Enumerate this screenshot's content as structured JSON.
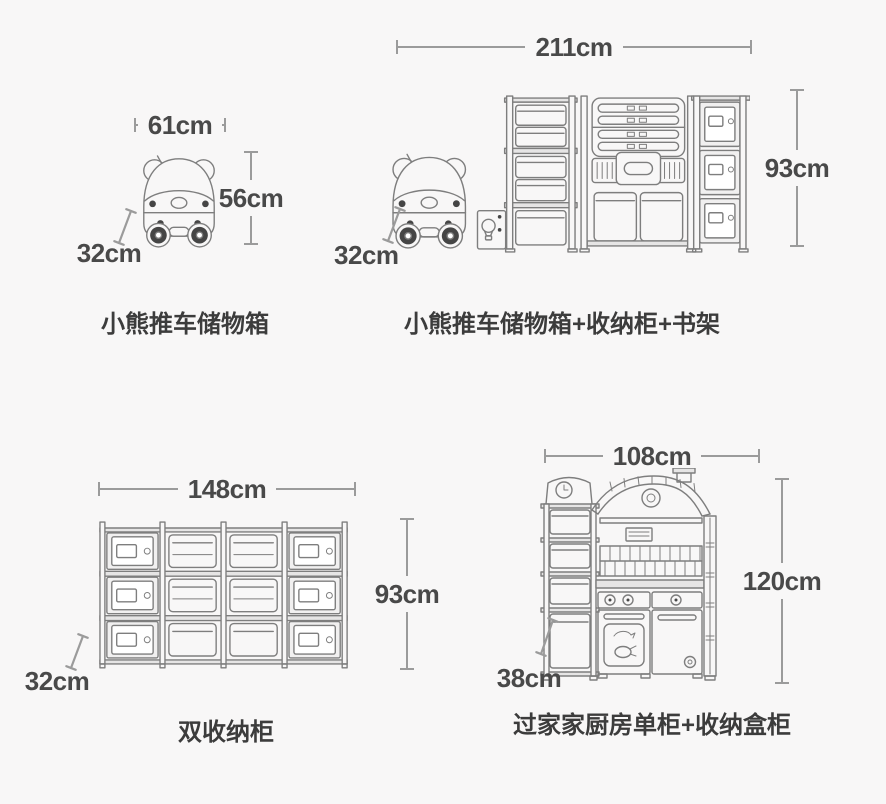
{
  "colors": {
    "bg": "#f8f7f7",
    "line": "#7e7e7e",
    "accent": "#454545",
    "dim_line": "#9b9b9b",
    "dim_text": "#494949",
    "label": "#3c3c3c",
    "rail": "#e6e5e5",
    "panel": "#f1f0f0"
  },
  "products": [
    {
      "id": "bear-cart",
      "name": "小熊推车储物箱",
      "width_label": "61cm",
      "height_label": "56cm",
      "depth_label": "32cm"
    },
    {
      "id": "bear-cart-combo",
      "name": "小熊推车储物箱+收纳柜+书架",
      "width_label": "211cm",
      "height_label": "93cm",
      "depth_label": "32cm"
    },
    {
      "id": "double-storage-cabinet",
      "name": "双收纳柜",
      "width_label": "148cm",
      "height_label": "93cm",
      "depth_label": "32cm"
    },
    {
      "id": "play-kitchen-combo",
      "name": "过家家厨房单柜+收纳盒柜",
      "width_label": "108cm",
      "height_label": "120cm",
      "depth_label": "38cm"
    }
  ]
}
